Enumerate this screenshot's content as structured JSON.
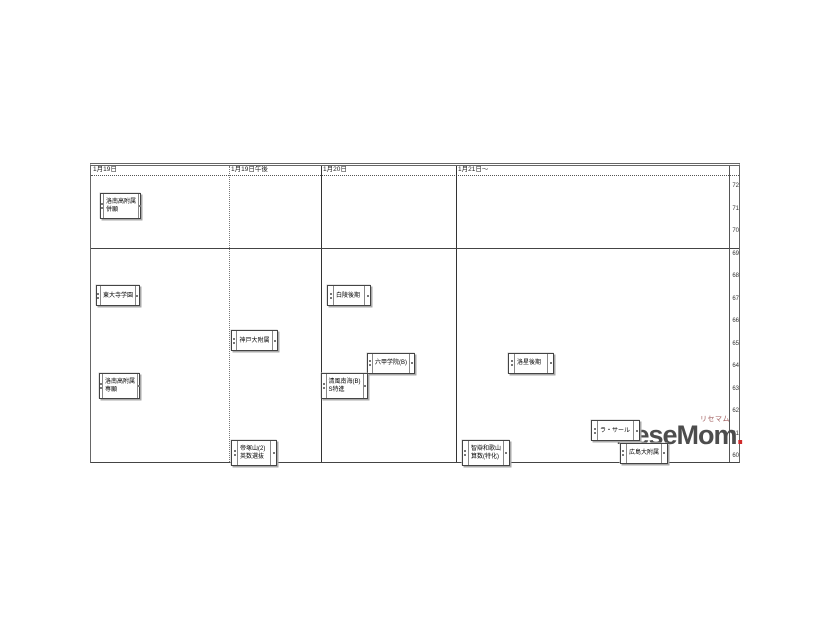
{
  "watermark": {
    "logo_text": "ReseMom",
    "dot": ".",
    "caption": "リセマム",
    "logo_color": "#4d4d4d",
    "dot_color": "#cf2b2b"
  },
  "chart_data": {
    "type": "table",
    "title": "中学入試 日程・偏差値チャート",
    "columns": [
      "1月19日",
      "1月19日午後",
      "1月20日",
      "1月21日～"
    ],
    "ylabel": "偏差値",
    "yticks": [
      72,
      71,
      70,
      69,
      68,
      67,
      66,
      65,
      64,
      63,
      62,
      61,
      60
    ],
    "ylim": [
      60,
      72
    ],
    "legend": "none",
    "grid": "column separators; horizontal rule between 70 and 69",
    "items": [
      {
        "column": "1月19日",
        "lines": [
          "洛南高附属",
          "併願"
        ],
        "hensachi": 71,
        "x": 10,
        "w": 41
      },
      {
        "column": "1月19日",
        "lines": [
          "東大寺学園"
        ],
        "hensachi": 67,
        "x": 6,
        "w": 44
      },
      {
        "column": "1月19日",
        "lines": [
          "洛南高附属",
          "専願"
        ],
        "hensachi": 63,
        "x": 9,
        "w": 41
      },
      {
        "column": "1月19日午後",
        "lines": [
          "神戸大附属"
        ],
        "hensachi": 65,
        "x": 141,
        "w": 47
      },
      {
        "column": "1月19日午後",
        "lines": [
          "帝塚山(2)",
          "英数選抜"
        ],
        "hensachi": 60,
        "x": 141,
        "w": 46
      },
      {
        "column": "1月20日",
        "lines": [
          "白陵後期"
        ],
        "hensachi": 67,
        "x": 237,
        "w": 44
      },
      {
        "column": "1月20日",
        "lines": [
          "六甲学院(B)"
        ],
        "hensachi": 64,
        "x": 277,
        "w": 48
      },
      {
        "column": "1月20日",
        "lines": [
          "清風南海(B)",
          "S特進"
        ],
        "hensachi": 63,
        "x": 231,
        "w": 47
      },
      {
        "column": "1月21日～",
        "lines": [
          "洛星後期"
        ],
        "hensachi": 64,
        "x": 418,
        "w": 46
      },
      {
        "column": "1月21日～",
        "lines": [
          "ラ・サール"
        ],
        "hensachi": 61,
        "x": 501,
        "w": 49
      },
      {
        "column": "1月21日～",
        "lines": [
          "智辯和歌山",
          "算数(特化)"
        ],
        "hensachi": 60,
        "x": 372,
        "w": 48
      },
      {
        "column": "1月21日～",
        "lines": [
          "広島大附属"
        ],
        "hensachi": 60,
        "x": 530,
        "w": 48
      }
    ]
  }
}
